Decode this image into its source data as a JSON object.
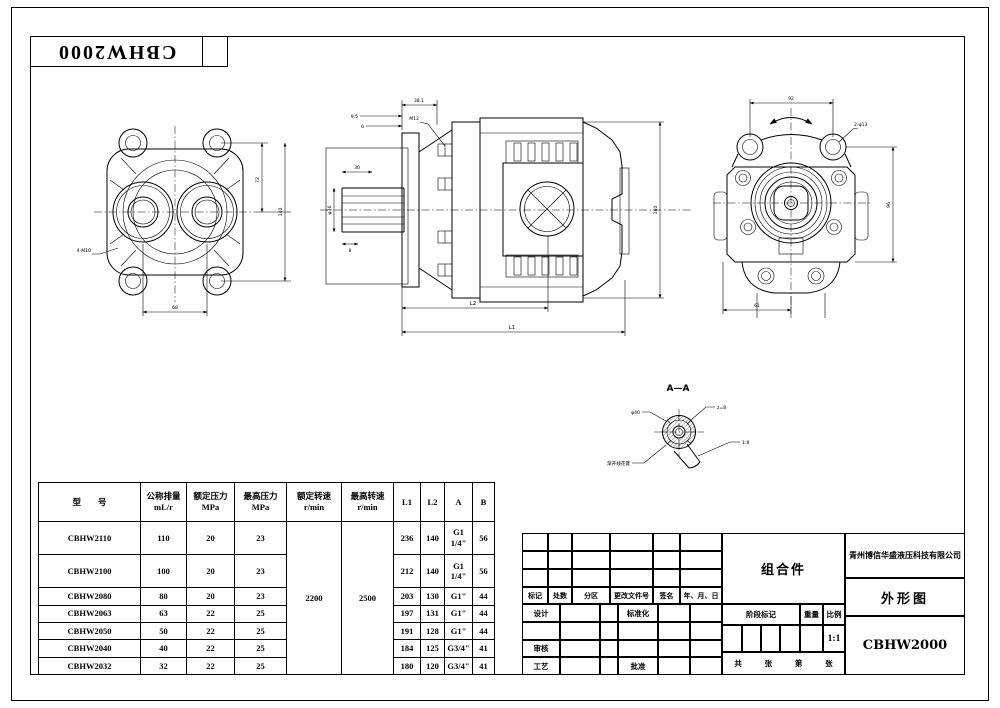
{
  "frame": {
    "series_label": "CBHW2000"
  },
  "views": {
    "front": {
      "dims": {
        "bottom": "68",
        "right_inner": "72",
        "right_outer": "140",
        "note": "4-M10"
      }
    },
    "side": {
      "dims": {
        "top": "38.1",
        "top_small_1": "9.5",
        "top_small_2": "6",
        "bolt_note": "M12",
        "shaft_dia": "φ36",
        "spline_len": "30",
        "spline_b": "8",
        "bottom_inner": "L2",
        "bottom_outer": "L1",
        "height": "160"
      }
    },
    "rear": {
      "dims": {
        "top": "92",
        "right": "96",
        "bottom": "61",
        "ear_note": "2-φ13"
      }
    },
    "section": {
      "title": "A—A",
      "labels": {
        "left": "φ40",
        "top_right": "z=8",
        "bottom_left": "渐开线花键",
        "bottom_right": "1:8"
      }
    }
  },
  "spec_table": {
    "col_model": "型　　号",
    "col_displacement": "公称排量",
    "col_displacement_unit": "mL/r",
    "col_rated_pressure": "额定压力",
    "col_rated_pressure_unit": "MPa",
    "col_max_pressure": "最高压力",
    "col_max_pressure_unit": "MPa",
    "col_rated_speed": "额定转速",
    "col_rated_speed_unit": "r/min",
    "col_max_speed": "最高转速",
    "col_max_speed_unit": "r/min",
    "col_l1": "L1",
    "col_l2": "L2",
    "col_a": "A",
    "col_b": "B",
    "rated_speed": "2200",
    "max_speed": "2500",
    "rows": [
      {
        "model": "CBHW2110",
        "displacement": "110",
        "rated_pressure": "20",
        "max_pressure": "23",
        "l1": "236",
        "l2": "140",
        "a": "G1 1/4\"",
        "b": "56"
      },
      {
        "model": "CBHW2100",
        "displacement": "100",
        "rated_pressure": "20",
        "max_pressure": "23",
        "l1": "212",
        "l2": "140",
        "a": "G1 1/4\"",
        "b": "56"
      },
      {
        "model": "CBHW2080",
        "displacement": "80",
        "rated_pressure": "20",
        "max_pressure": "23",
        "l1": "203",
        "l2": "130",
        "a": "G1\"",
        "b": "44"
      },
      {
        "model": "CBHW2063",
        "displacement": "63",
        "rated_pressure": "22",
        "max_pressure": "25",
        "l1": "197",
        "l2": "131",
        "a": "G1\"",
        "b": "44"
      },
      {
        "model": "CBHW2050",
        "displacement": "50",
        "rated_pressure": "22",
        "max_pressure": "25",
        "l1": "191",
        "l2": "128",
        "a": "G1\"",
        "b": "44"
      },
      {
        "model": "CBHW2040",
        "displacement": "40",
        "rated_pressure": "22",
        "max_pressure": "25",
        "l1": "184",
        "l2": "125",
        "a": "G3/4\"",
        "b": "41"
      },
      {
        "model": "CBHW2032",
        "displacement": "32",
        "rated_pressure": "22",
        "max_pressure": "25",
        "l1": "180",
        "l2": "120",
        "a": "G3/4\"",
        "b": "41"
      }
    ]
  },
  "title_block": {
    "rev_headers": [
      "标记",
      "处数",
      "分区",
      "更改文件号",
      "签名",
      "年、月、日"
    ],
    "design_label": "设计",
    "standardization_label": "标准化",
    "review_label": "审核",
    "process_label": "工艺",
    "approve_label": "批准",
    "part_name": "组合件",
    "stage_label": "阶段标记",
    "weight_label": "重量",
    "scale_label": "比例",
    "scale_value": "1:1",
    "sheets_label": "共",
    "sheets_unit": "张",
    "page_label": "第",
    "page_unit": "张",
    "company": "青州博信华盛液压科技有限公司",
    "drawing_name": "外形图",
    "model": "CBHW2000"
  }
}
